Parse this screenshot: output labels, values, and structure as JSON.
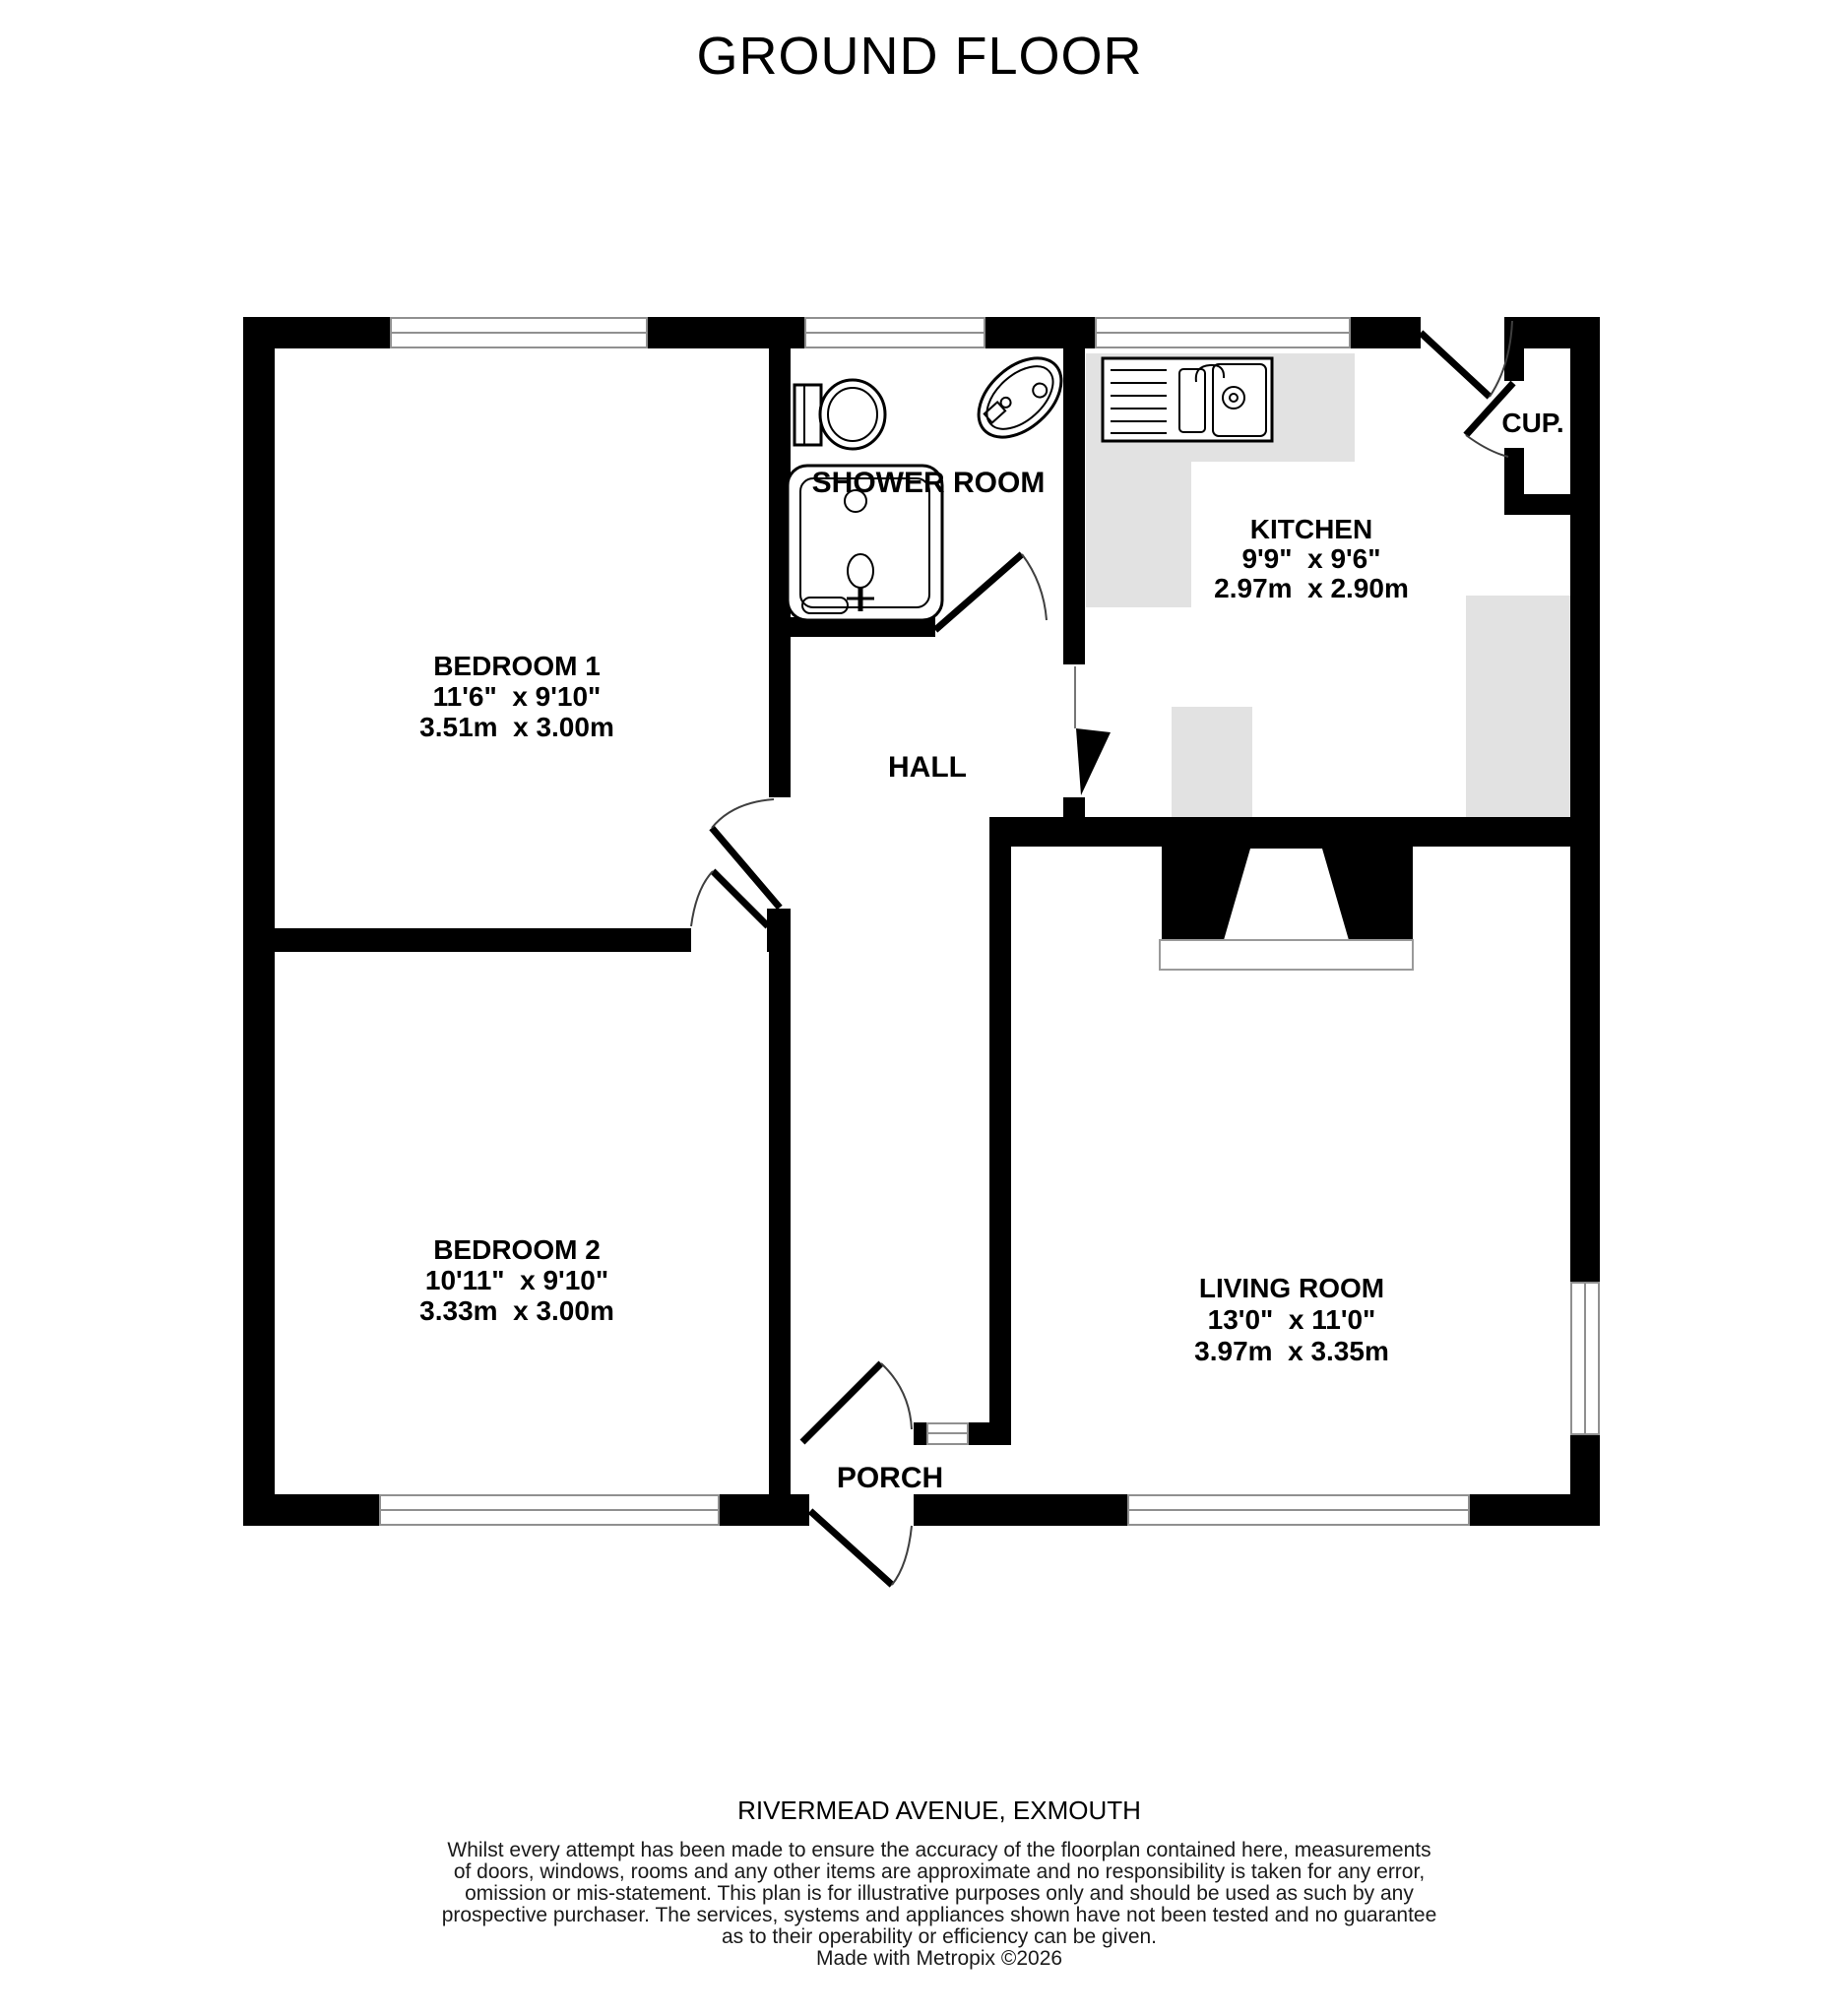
{
  "title": "GROUND FLOOR",
  "address": "RIVERMEAD AVENUE, EXMOUTH",
  "rooms": {
    "bedroom1": {
      "name": "BEDROOM 1",
      "imperial": "11'6\"  x 9'10\"",
      "metric": "3.51m  x 3.00m"
    },
    "bedroom2": {
      "name": "BEDROOM 2",
      "imperial": "10'11\"  x 9'10\"",
      "metric": "3.33m  x 3.00m"
    },
    "kitchen": {
      "name": "KITCHEN",
      "imperial": "9'9\"  x 9'6\"",
      "metric": "2.97m  x 2.90m"
    },
    "living_room": {
      "name": "LIVING ROOM",
      "imperial": "13'0\"  x 11'0\"",
      "metric": "3.97m  x 3.35m"
    },
    "shower_room": {
      "name": "SHOWER ROOM"
    },
    "hall": {
      "name": "HALL"
    },
    "porch": {
      "name": "PORCH"
    },
    "cupboard": {
      "name": "CUP."
    }
  },
  "disclaimer": {
    "line1": "Whilst every attempt has been made to ensure the accuracy of the floorplan contained here, measurements",
    "line2": "of doors, windows, rooms and any other items are approximate and no responsibility is taken for any error,",
    "line3": "omission or mis-statement. This plan is for illustrative purposes only and should be used as such by any",
    "line4": "prospective purchaser. The services, systems and appliances shown have not been tested and no guarantee",
    "line5": "as to their operability or efficiency can be given.",
    "credit": "Made with Metropix ©2026"
  },
  "colors": {
    "wall": "#000000",
    "counter": "#e2e2e2",
    "window_line": "#909090",
    "door_arc": "#3f3f3f"
  }
}
